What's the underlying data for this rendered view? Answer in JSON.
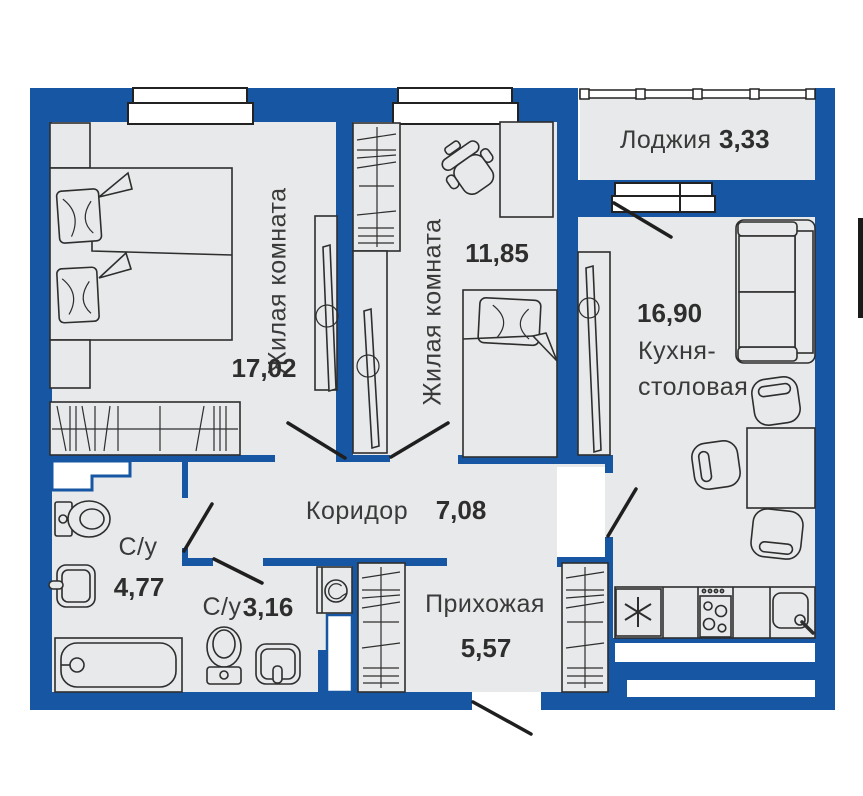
{
  "colors": {
    "wall": "#1656a3",
    "floor": "#e8e9ea",
    "line": "#2e2e2e",
    "swing": "#1f1f1f"
  },
  "rooms": {
    "living1": {
      "label": "Жилая комната",
      "area": "17,02"
    },
    "living2": {
      "label": "Жилая комната",
      "area": "11,85"
    },
    "loggia": {
      "label": "Лоджия",
      "area": "3,33"
    },
    "kitchen": {
      "label_line1": "Кухня-",
      "label_line2": "столовая",
      "area": "16,90"
    },
    "corridor": {
      "label": "Коридор",
      "area": "7,08"
    },
    "bathroom_large": {
      "label": "С/у",
      "area": "4,77"
    },
    "bathroom_small": {
      "label": "С/у",
      "area": "3,16"
    },
    "hallway": {
      "label": "Прихожая",
      "area": "5,57"
    }
  }
}
